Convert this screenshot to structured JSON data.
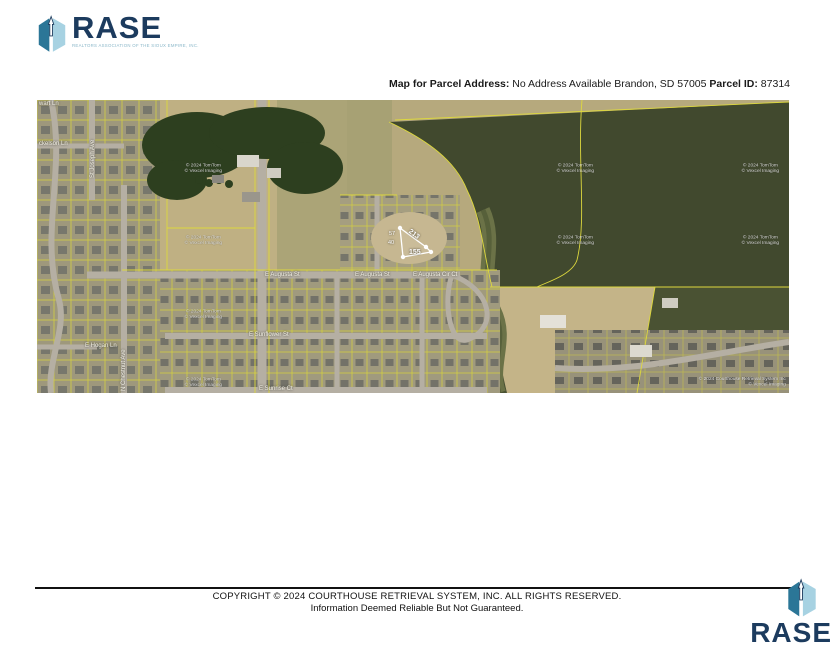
{
  "brand": {
    "name": "RASE",
    "tagline": "REALTORS ASSOCIATION OF THE SIOUX EMPIRE, INC."
  },
  "header": {
    "address_label": "Map for Parcel Address:",
    "address_value": "No Address Available Brandon, SD 57005",
    "parcel_label": "Parcel ID:",
    "parcel_value": "87314"
  },
  "map": {
    "street_labels": [
      {
        "text": "wart Ln"
      },
      {
        "text": "ckelson Ln"
      },
      {
        "text": "St Joseph Ave"
      },
      {
        "text": "N Chestnut Ave"
      },
      {
        "text": "E Hogan Ln"
      },
      {
        "text": "E Augusta St"
      },
      {
        "text": "E Augusta St"
      },
      {
        "text": "E Augusta Cir Ct"
      },
      {
        "text": "E Sunflower St"
      },
      {
        "text": "E Sunrise Ct"
      }
    ],
    "watermark_line1": "© 2024 TomTom",
    "watermark_line2": "© Vexcel Imaging",
    "credit_line1": "© 2024 Courthouse Retrieval System Inc",
    "credit_line2": "© Vexcel Imaging",
    "parcel": {
      "dim_hypotenuse": "213",
      "dim_bottom": "155",
      "dim_left_top": "57",
      "dim_left_bottom": "40"
    }
  },
  "footer": {
    "line1": "COPYRIGHT © 2024 COURTHOUSE RETRIEVAL SYSTEM, INC. ALL RIGHTS RESERVED.",
    "line2": "Information Deemed Reliable But Not Guaranteed."
  },
  "colors": {
    "navy": "#1c3b5e",
    "cube_left": "#2b7697",
    "cube_right": "#a7d2e2",
    "parcel_line_yellow": "#ddd83e",
    "highlight_white": "#ffffff"
  }
}
